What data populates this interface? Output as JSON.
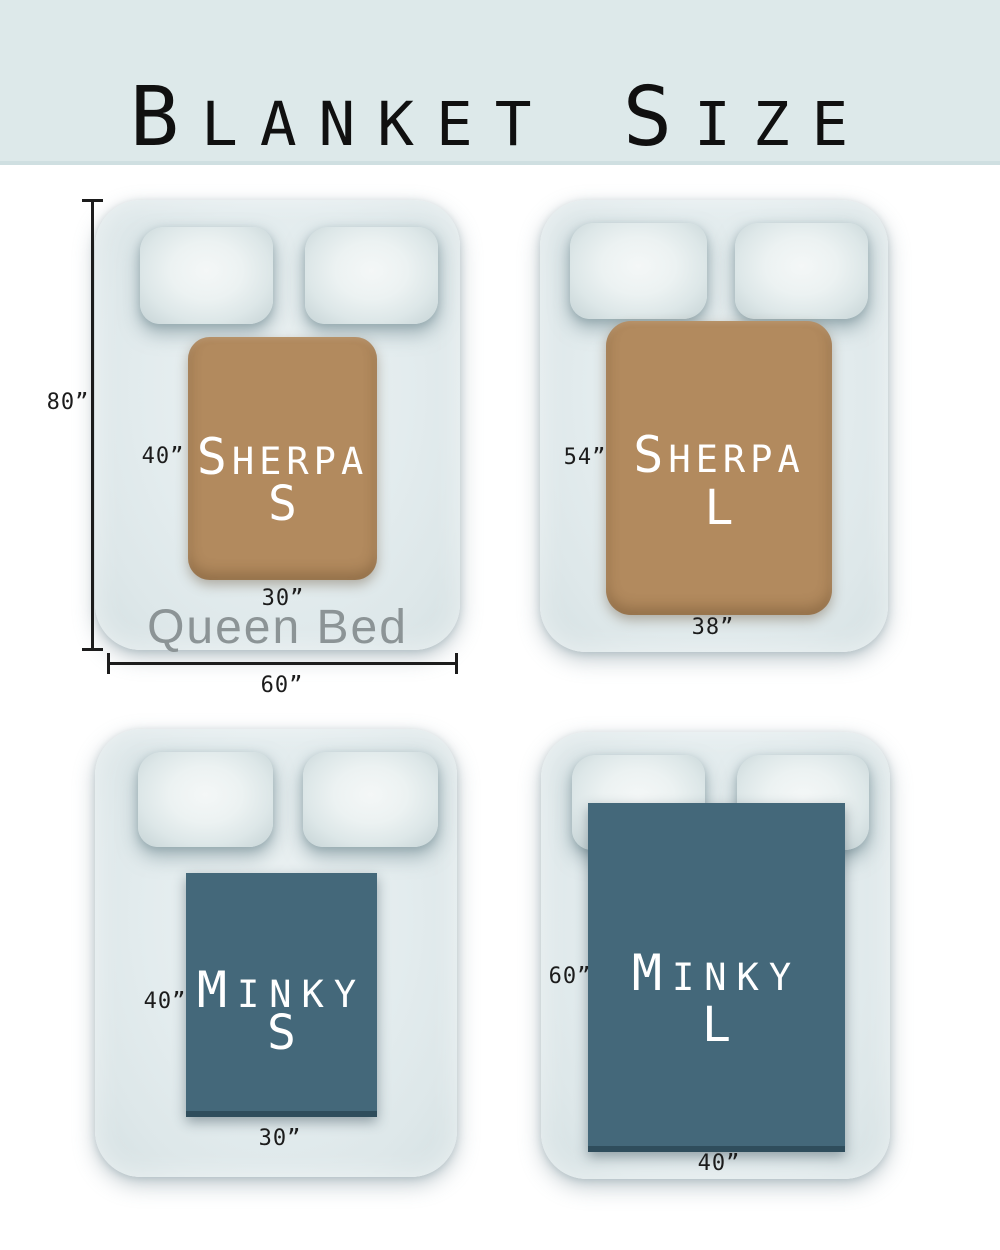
{
  "header": {
    "title_words": [
      {
        "lead": "B",
        "rest": "LANKET"
      },
      {
        "lead": "S",
        "rest": "IZE"
      }
    ]
  },
  "colors": {
    "header_bg": "#dde9ea",
    "page_bg": "#ffffff",
    "sherpa_blanket": "#b28a5e",
    "minky_blanket": "#44687a",
    "blanket_text": "#ffffff",
    "dimension_text": "#1c1c1c",
    "bed_name_text": "#8c9496"
  },
  "beds": [
    {
      "blanket_line1_lead": "S",
      "blanket_line1_rest": "HERPA",
      "size_letter": "S",
      "blanket_width_label": "30”",
      "blanket_height_label": "40”",
      "bed_name": "Queen Bed",
      "bed_height_label": "80”",
      "bed_width_label": "60”"
    },
    {
      "blanket_line1_lead": "S",
      "blanket_line1_rest": "HERPA",
      "size_letter": "L",
      "blanket_width_label": "38”",
      "blanket_height_label": "54”"
    },
    {
      "blanket_line1_lead": "M",
      "blanket_line1_rest": "INKY",
      "size_letter": "S",
      "blanket_width_label": "30”",
      "blanket_height_label": "40”"
    },
    {
      "blanket_line1_lead": "M",
      "blanket_line1_rest": "INKY",
      "size_letter": "L",
      "blanket_width_label": "40”",
      "blanket_height_label": "60”"
    }
  ]
}
